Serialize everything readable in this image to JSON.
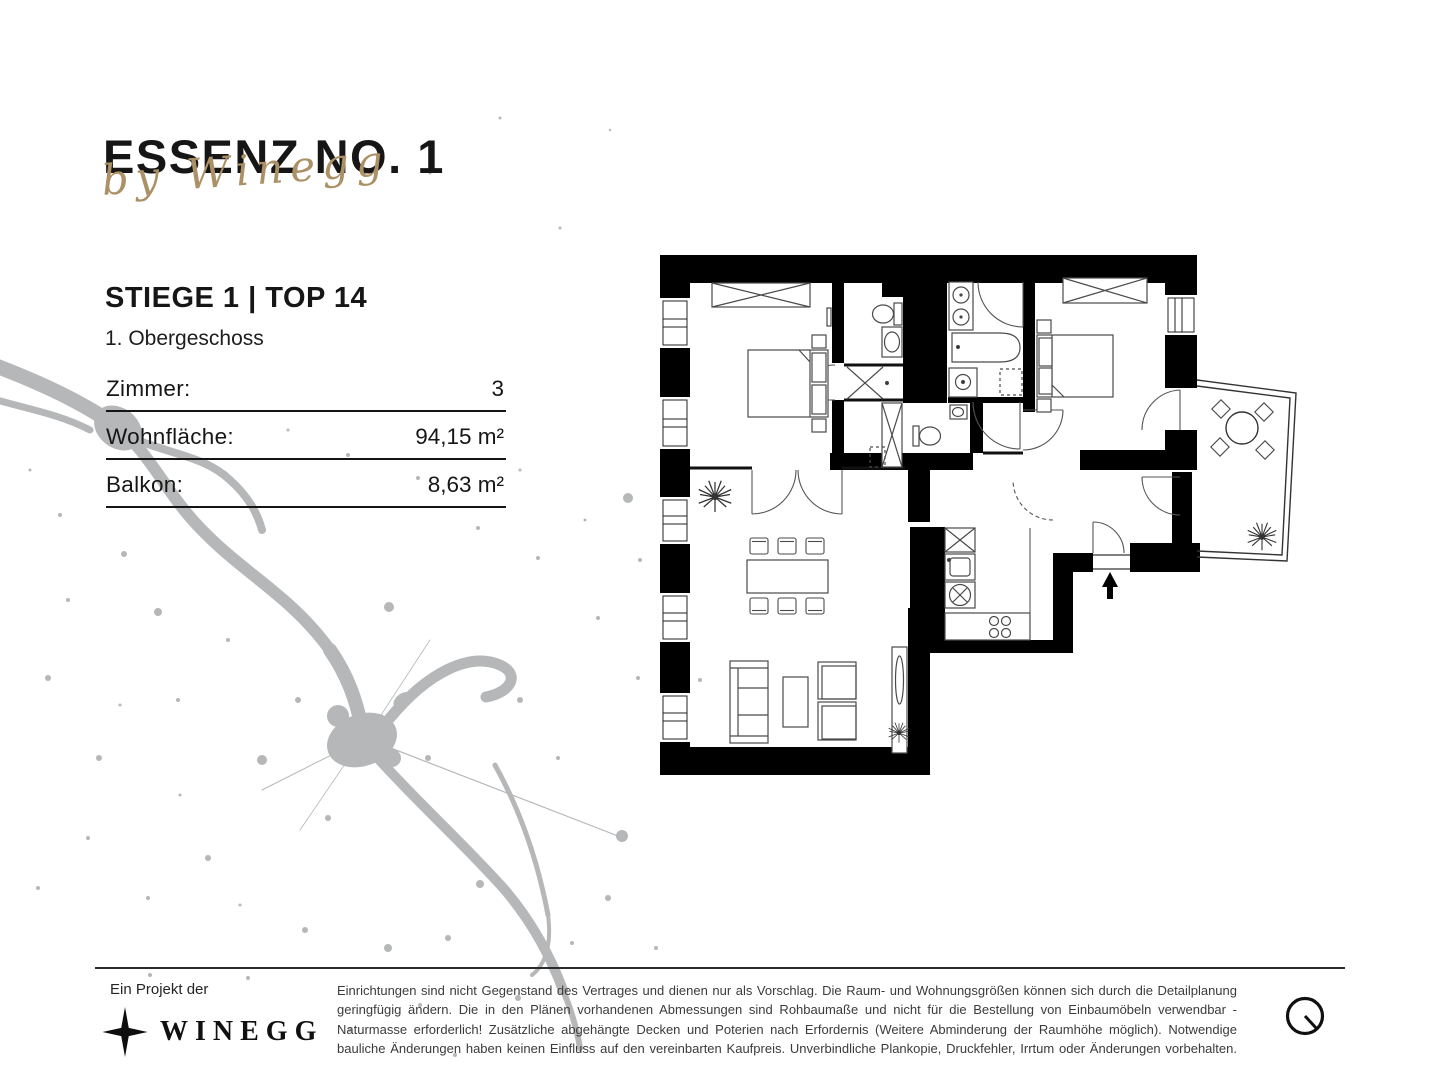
{
  "colors": {
    "text": "#161616",
    "accent_gold": "#ac9166",
    "splatter_gray": "#b5b7b8",
    "wall_black": "#000000"
  },
  "header": {
    "project_title": "ESSENZ NO. 1",
    "byline": "by Winegg"
  },
  "unit": {
    "name": "STIEGE 1 | TOP 14",
    "floor": "1. Obergeschoss"
  },
  "specs": {
    "rows": [
      {
        "label": "Zimmer:",
        "value": "3"
      },
      {
        "label": "Wohnfläche:",
        "value": "94,15 m²"
      },
      {
        "label": "Balkon:",
        "value": "8,63 m²"
      }
    ]
  },
  "floorplan": {
    "type": "apartment-floor-plan",
    "style": "black walls on white, furniture line drawings",
    "icons": {
      "entrance_arrow": "arrow-up",
      "plant": "plant-burst",
      "balcony_table": "round-table-with-4-chairs",
      "shower": "x-cross",
      "wardrobe": "crossed-rectangle"
    }
  },
  "footer": {
    "project_label": "Ein Projekt der",
    "brand": "WINEGG",
    "brand_icon": "four-point-star",
    "north_icon": "circle-with-needle",
    "disclaimer": "Einrichtungen sind nicht Gegenstand des Vertrages und dienen nur als Vorschlag. Die Raum- und Wohnungsgrößen können sich durch die Detailplanung geringfügig ändern. Die in den Plänen vorhandenen Abmessungen sind Rohbaumaße und nicht für die Bestellung von Einbaumöbeln verwendbar - Naturmasse erforderlich! Zusätzliche abgehängte Decken und Poterien nach Erfordernis (Weitere Abminderung der Raumhöhe möglich). Notwendige bauliche Änderungen haben keinen Einfluss auf den vereinbarten Kaufpreis. Unverbindliche Plankopie, Druckfehler, Irrtum oder Änderungen vorbehalten."
  }
}
